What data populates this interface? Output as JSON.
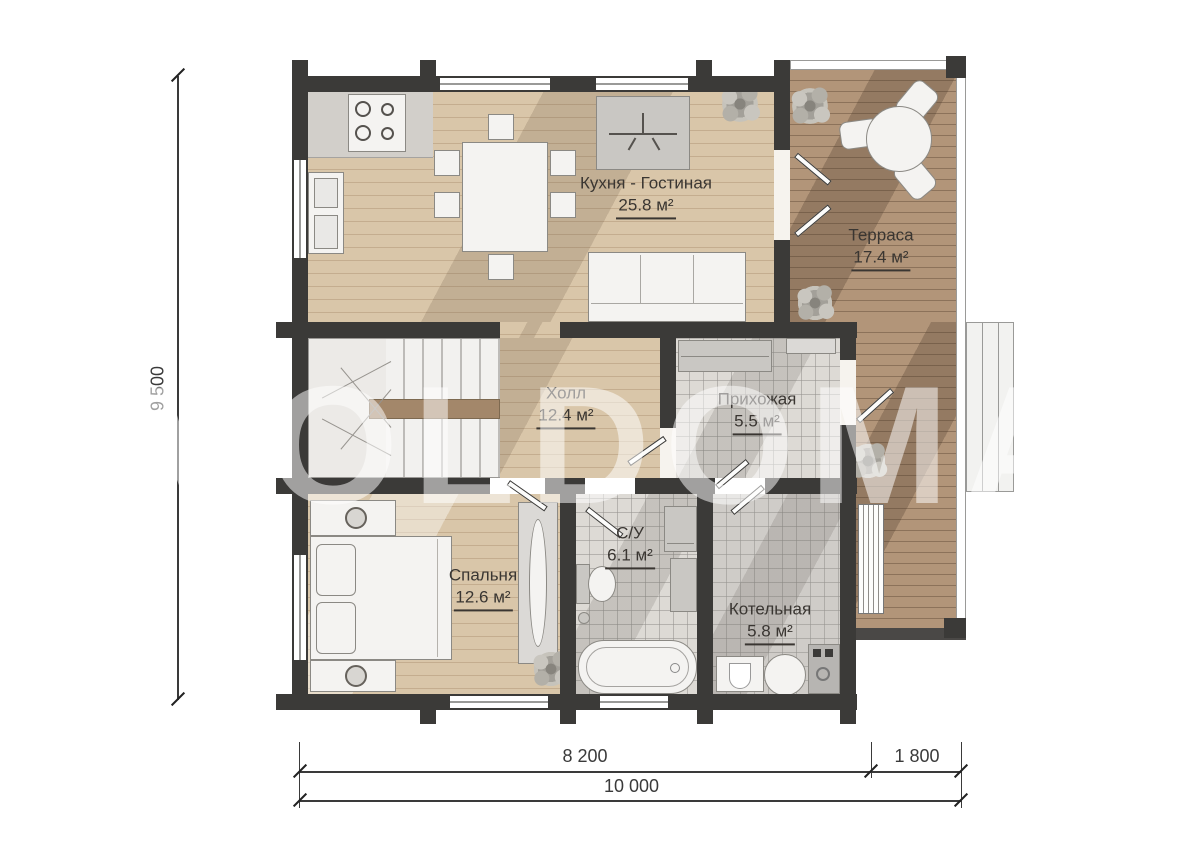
{
  "watermark": "VOLDOMA",
  "rooms": [
    {
      "name": "Кухня - Гостиная",
      "area": "25.8 м²"
    },
    {
      "name": "Терраса",
      "area": "17.4 м²"
    },
    {
      "name": "Холл",
      "area": "12.4 м²"
    },
    {
      "name": "Прихожая",
      "area": "5.5 м²"
    },
    {
      "name": "Спальня",
      "area": "12.6 м²"
    },
    {
      "name": "С/У",
      "area": "6.1 м²"
    },
    {
      "name": "Котельная",
      "area": "5.8 м²"
    }
  ],
  "dimensions": {
    "total_height": "9 500",
    "house_width": "8 200",
    "terrace_width": "1 800",
    "total_width": "10 000"
  },
  "colors": {
    "wall": "#3b3a38",
    "wood_floor": "#d9c6a9",
    "terrace_deck": "#b29579",
    "tile_floor": "#dddad5",
    "label_text": "#3a3632"
  }
}
